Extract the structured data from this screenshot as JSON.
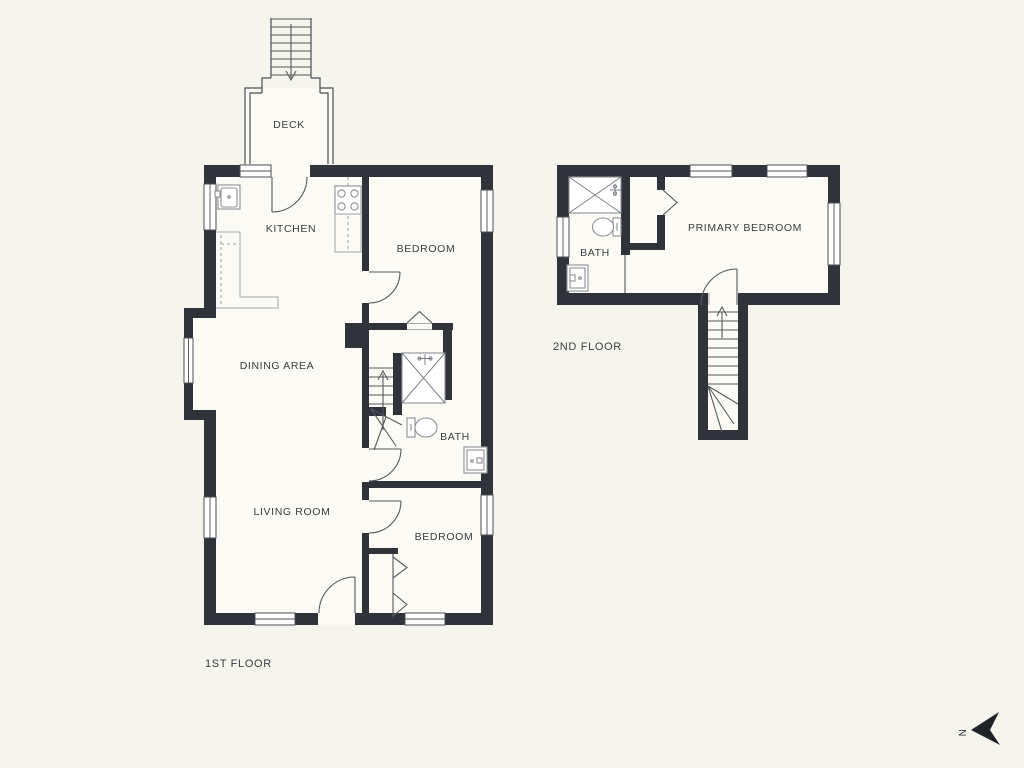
{
  "colors": {
    "background": "#f5f4ed",
    "floor": "#fbfaf5",
    "wall": "#30343a",
    "line": "#55585c",
    "fixture": "#8d9094",
    "text": "#3a3e42"
  },
  "floor1": {
    "label": "1ST FLOOR",
    "rooms": {
      "deck": "DECK",
      "kitchen": "KITCHEN",
      "bedroom_top": "BEDROOM",
      "dining": "DINING AREA",
      "bath": "BATH",
      "living": "LIVING ROOM",
      "bedroom_bottom": "BEDROOM"
    }
  },
  "floor2": {
    "label": "2ND FLOOR",
    "rooms": {
      "bath": "BATH",
      "primary_bedroom": "PRIMARY BEDROOM"
    }
  },
  "compass": {
    "north": "N"
  }
}
